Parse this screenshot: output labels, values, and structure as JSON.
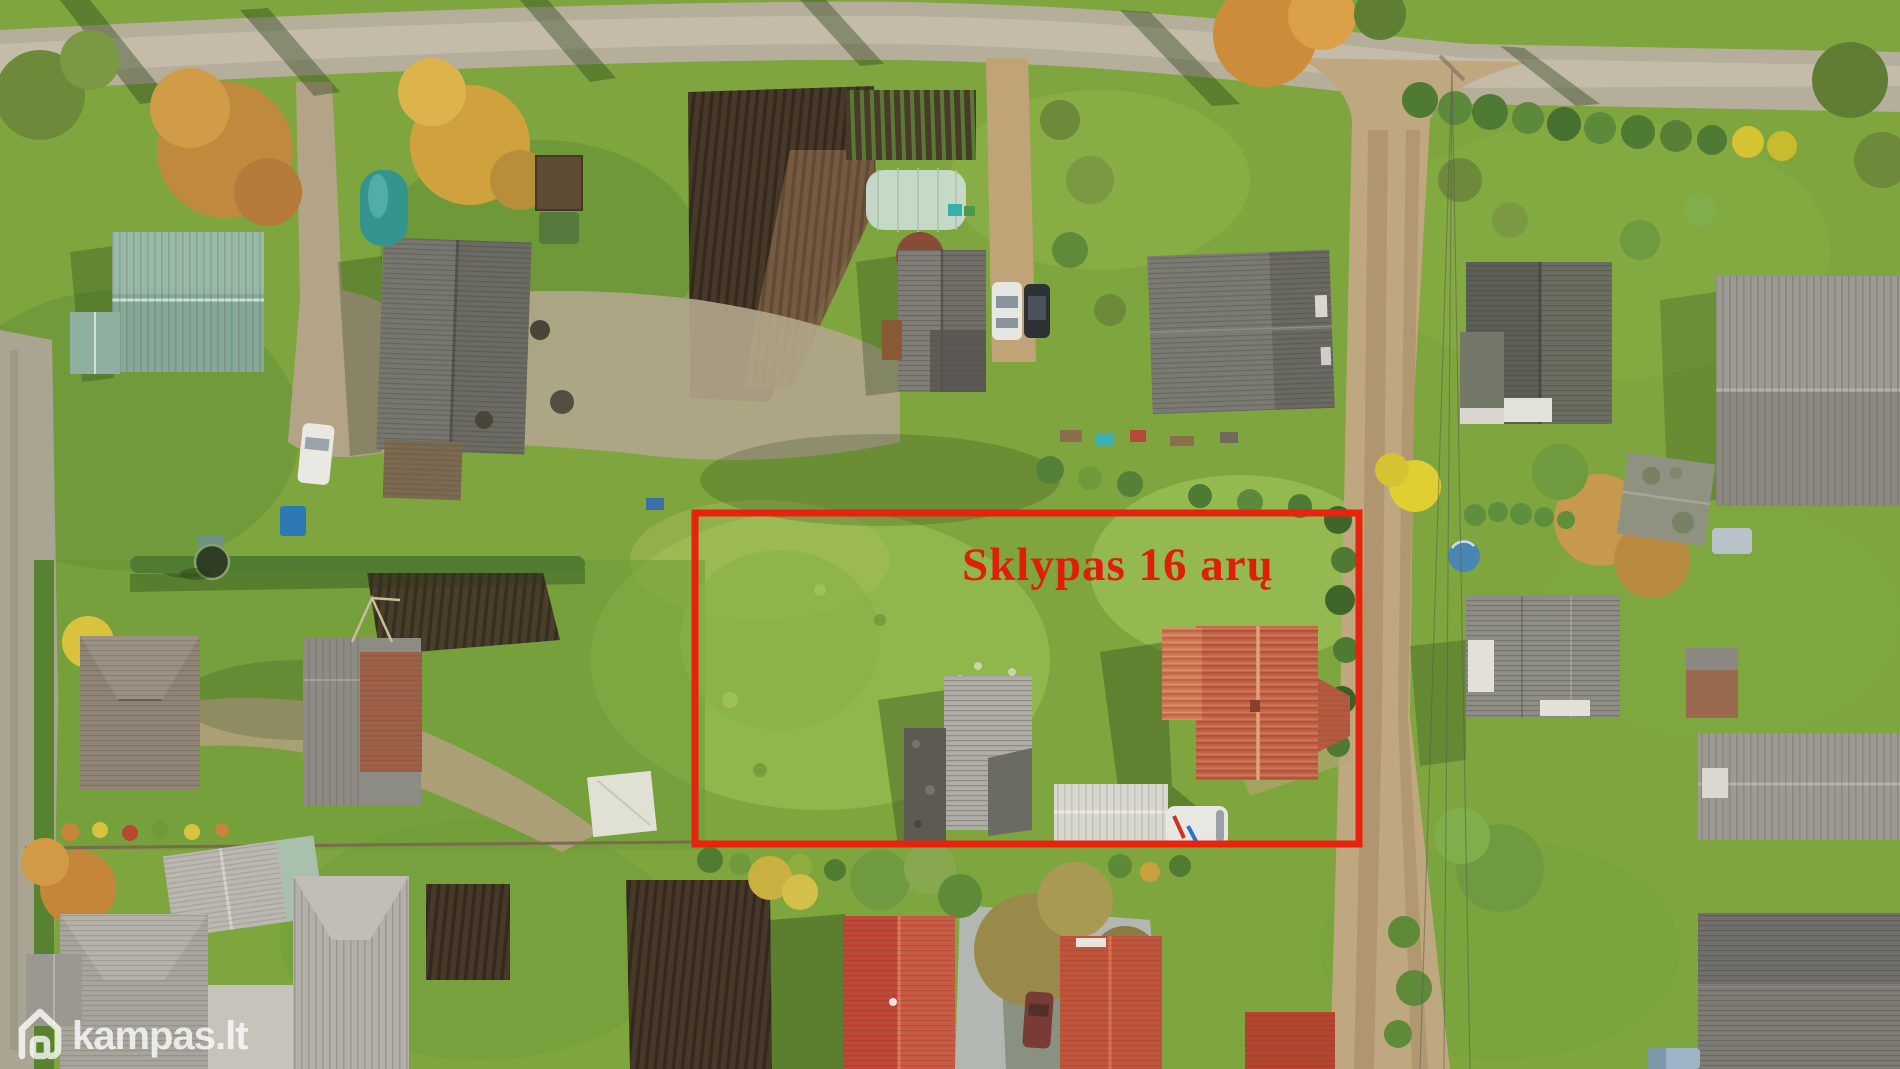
{
  "annotation": {
    "plot_label": "Sklypas 16 arų",
    "box_color": "#e8220d",
    "text_color": "#df1f0b",
    "box": {
      "x": 695,
      "y": 513,
      "width": 664,
      "height": 331,
      "stroke_width": 7
    }
  },
  "watermark": {
    "text": "kampas.lt",
    "icon": "house-outline-icon",
    "color": "#ffffff",
    "opacity": 0.78
  }
}
